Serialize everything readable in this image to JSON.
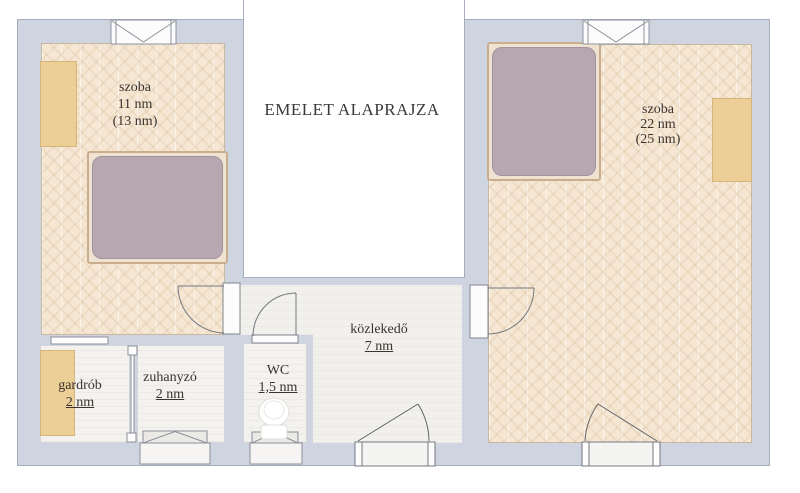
{
  "title": "EMELET ALAPRAJZA",
  "rooms": {
    "room1": {
      "name": "szoba",
      "area": "11 nm",
      "area_alt": "(13 nm)"
    },
    "room2": {
      "name": "szoba",
      "area": "22 nm",
      "area_alt": "(25 nm)"
    },
    "hallway": {
      "name": "közlekedő",
      "area": "7 nm"
    },
    "wardrobe": {
      "name": "gardrób",
      "area": "2 nm"
    },
    "shower": {
      "name": "zuhanyzó",
      "area": "2 nm"
    },
    "wc": {
      "name": "WC",
      "area": "1,5 nm"
    }
  },
  "colors": {
    "wall": "#cfd5e0",
    "wall_outline": "#a6aebc",
    "parquet_floor": "#f5e7d4",
    "wet_room_floor": "#f3f2ef",
    "furniture_wood": "#ecce97",
    "mattress": "#b6a7b0"
  }
}
